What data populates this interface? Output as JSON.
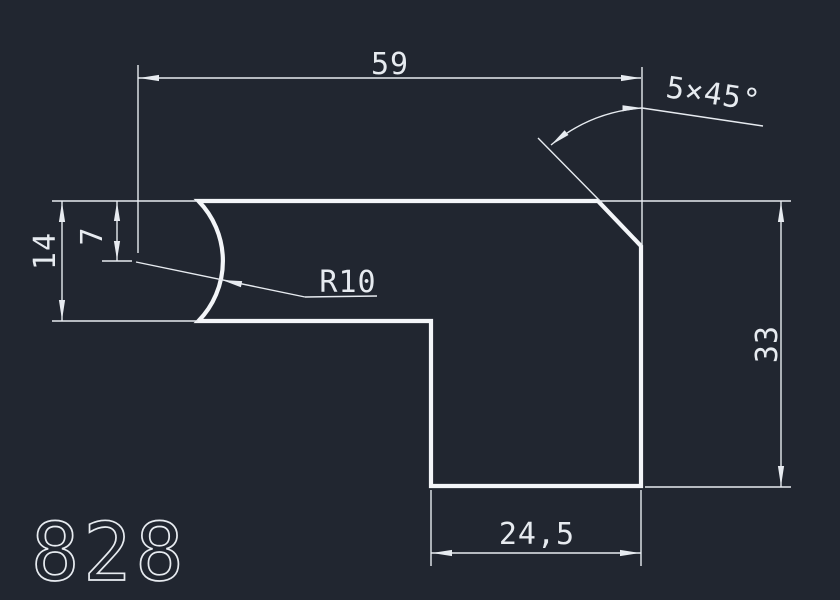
{
  "canvas": {
    "background_color": "#212630",
    "line_color": "#e7ebf0",
    "type": "CAD technical drawing"
  },
  "drawing_number": "828",
  "labels": {
    "dim_width_top": "59",
    "chamfer_note": "5×45°",
    "dim_offset_center": "7",
    "dim_height_left": "14",
    "radius_note": "R10",
    "dim_height_right": "33",
    "dim_width_bottom": "24,5"
  },
  "part": {
    "shape": "L-shaped profile with concave left edge and chamfered top-right corner",
    "dimensions": [
      {
        "label": "59",
        "value": 59,
        "kind": "linear",
        "orientation": "horizontal",
        "measures": "overall width from R10 arc center to right edge"
      },
      {
        "label": "5×45°",
        "value_size": 5,
        "value_angle_deg": 45,
        "kind": "chamfer",
        "measures": "top-right corner chamfer"
      },
      {
        "label": "7",
        "value": 7,
        "kind": "linear",
        "orientation": "vertical",
        "measures": "top edge to R10 arc center"
      },
      {
        "label": "14",
        "value": 14,
        "kind": "linear",
        "orientation": "vertical",
        "measures": "height of upper-left section"
      },
      {
        "label": "R10",
        "value": 10,
        "kind": "radius",
        "measures": "concave arc on left edge"
      },
      {
        "label": "33",
        "value": 33,
        "kind": "linear",
        "orientation": "vertical",
        "measures": "overall height of right side"
      },
      {
        "label": "24,5",
        "value": 24.5,
        "kind": "linear",
        "orientation": "horizontal",
        "measures": "width of lower leg"
      }
    ]
  }
}
